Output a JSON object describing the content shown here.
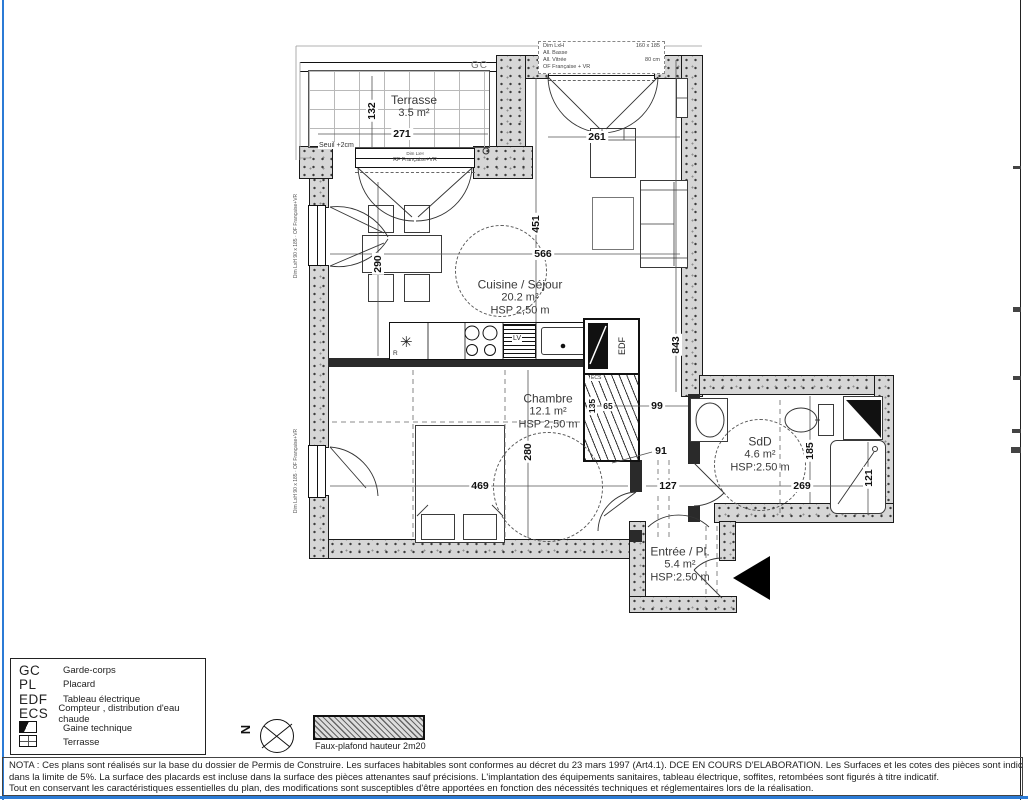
{
  "plan": {
    "rooms": {
      "terrasse": {
        "name": "Terrasse",
        "area": "3.5 m²"
      },
      "cuisine": {
        "name": "Cuisine / Séjour",
        "area": "20.2 m²",
        "hsp": "HSP 2,50 m"
      },
      "chambre": {
        "name": "Chambre",
        "area": "12.1 m²",
        "hsp": "HSP 2,50 m"
      },
      "sdd": {
        "name": "SdD",
        "area": "4.6 m²",
        "hsp": "HSP:2.50 m"
      },
      "entree": {
        "name": "Entrée / Pl.",
        "area": "5.4 m²",
        "hsp": "HSP:2.50 m"
      }
    },
    "dims": {
      "d271": "271",
      "d132": "132",
      "d261": "261",
      "d566": "566",
      "d451": "451",
      "d290": "290",
      "d843": "843",
      "d280": "280",
      "d469": "469",
      "d135": "135",
      "d65": "65",
      "d99": "99",
      "d91": "91",
      "d127": "127",
      "d269": "269",
      "d185": "185",
      "d121": "121"
    },
    "labels": {
      "gc": "GC",
      "seuil": "Seuil +2cm",
      "edf": "EDF",
      "lv": "LV",
      "r": "R",
      "ecs": "ECS"
    },
    "window_notes": {
      "top": {
        "l1a": "Dim LxH",
        "l1b": "160 x 185",
        "l2": "All. Basse",
        "l3a": "All. Vitrée",
        "l3b": "80 cm",
        "l4": "OF Française + VR"
      },
      "terrace_door": {
        "l1": "Dim LxH",
        "l2": "RF Française+VR"
      },
      "left1": "Dim LxH 90 x 185 · OF Française+VR",
      "left2": "Dim LxH 90 x 185 · OF Française+VR"
    }
  },
  "legend": {
    "items": [
      {
        "abbr": "GC",
        "label": "Garde-corps"
      },
      {
        "abbr": "PL",
        "label": "Placard"
      },
      {
        "abbr": "EDF",
        "label": "Tableau électrique"
      },
      {
        "abbr": "ECS",
        "label": "Compteur , distribution d'eau chaude"
      },
      {
        "abbr": "",
        "label": "Gaine technique"
      },
      {
        "abbr": "",
        "label": "Terrasse"
      }
    ]
  },
  "compass": {
    "north": "N"
  },
  "faux_plafond_label": "Faux-plafond hauteur 2m20",
  "nota": {
    "line1": "NOTA : Ces plans sont réalisés sur la base du dossier de Permis de Construire. Les surfaces habitables sont conformes au décret du 23 mars 1997 (Art4.1). DCE EN COURS D'ELABORATION. Les Surfaces et les cotes des pièces sont indicatives et pourront varier",
    "line2": "dans la limite de 5%. La surface des placards est incluse dans la surface des pièces attenantes sauf précisions. L'implantation des équipements sanitaires, tableau électrique, soffites, retombées sont figurés à titre indicatif.",
    "line3": "Tout en conservant les caractéristiques essentielles du plan, des modifications sont susceptibles d'être apportées en fonction des nécessités techniques et réglementaires lors de la réalisation."
  }
}
